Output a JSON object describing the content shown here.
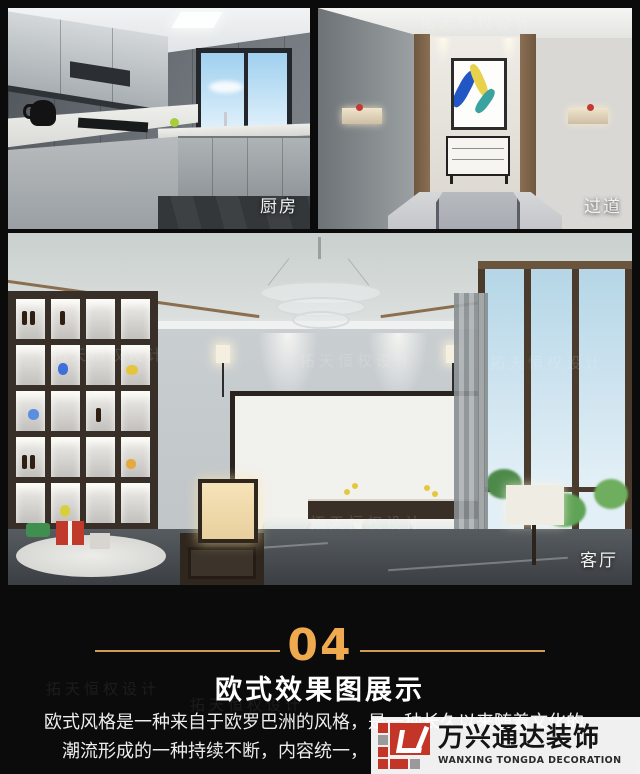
{
  "page": {
    "background": "#0b0b0b"
  },
  "gallery": {
    "kitchen_label": "厨房",
    "corridor_label": "过道",
    "living_label": "客厅"
  },
  "section": {
    "number": "04",
    "title": "欧式效果图展示",
    "desc_line1": "欧式风格是一种来自于欧罗巴洲的风格，是一种长久以来随着文化的",
    "desc_line2": "潮流形成的一种持续不断，内容统一，",
    "accent_color": "#efa94e"
  },
  "brand": {
    "name_cn": "万兴通达装饰",
    "name_en": "WANXING TONGDA DECORATION",
    "red": "#c23527",
    "gray": "#9a9a9a"
  },
  "watermark": {
    "text": "拓天恒权设计"
  }
}
